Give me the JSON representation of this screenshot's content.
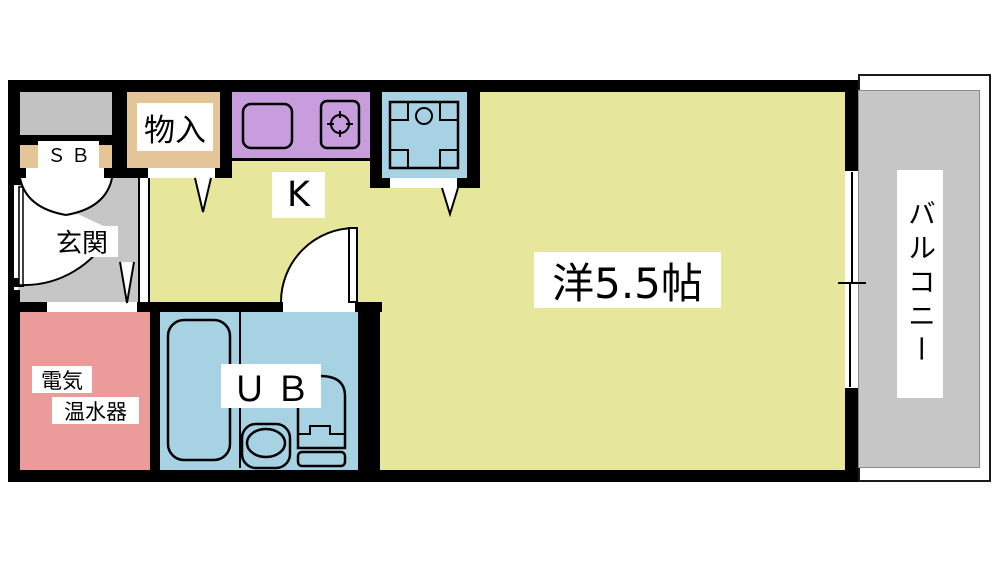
{
  "rooms": {
    "meter_box": {
      "label": ""
    },
    "storage_box": {
      "label": "ＳＢ"
    },
    "closet": {
      "label": "物入"
    },
    "kitchen": {
      "label": "K"
    },
    "entrance": {
      "label": "玄関"
    },
    "western_room": {
      "label": "洋5.5帖"
    },
    "water_heater": {
      "label_line1": "電気",
      "label_line2": "温水器"
    },
    "unit_bath": {
      "label": "ＵＢ"
    },
    "balcony": {
      "label": "バルコニー"
    }
  },
  "colors": {
    "room_yellow": "#e7e79b",
    "kitchen_purple": "#c79ddd",
    "bath_blue": "#a7d2e3",
    "heater_pink": "#ec9b9b",
    "closet_tan": "#e3c598",
    "floor_gray": "#c6c6c6",
    "wall_black": "#000000",
    "background": "#ffffff"
  }
}
